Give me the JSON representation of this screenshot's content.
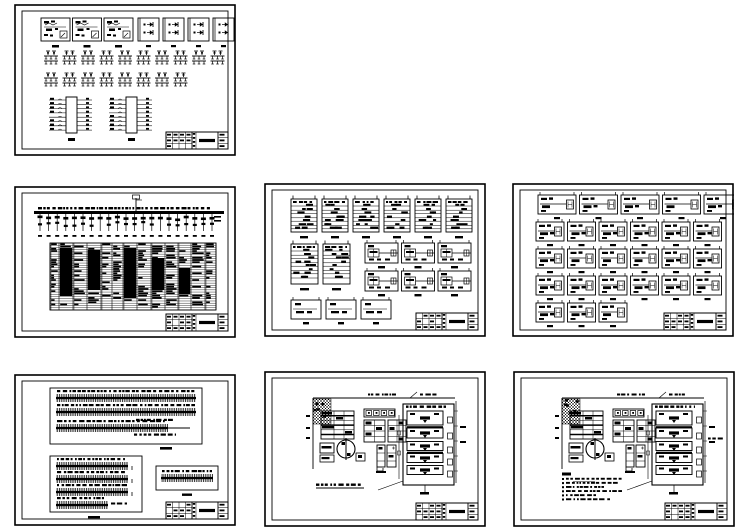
{
  "page": {
    "width": 749,
    "height": 530,
    "background": "#ffffff",
    "ink": "#000000",
    "kind": "cad-drawing-set-overview",
    "sheet_count": 7
  },
  "sheets": [
    {
      "id": "sheet-1",
      "name": "control-modules-schematic-sheet",
      "x": 14,
      "y": 4,
      "w": 222,
      "h": 152,
      "type": "relay_sheet",
      "seed": 11,
      "content": {
        "module_boxes_complex": 3,
        "module_boxes_simple": 4,
        "symbols_row1": 10,
        "symbols_row2": 8,
        "terminal_blocks": 2,
        "terminal_block_pins_per_side": 8,
        "has_title_block": true
      }
    },
    {
      "id": "sheet-2",
      "name": "distribution-system-schedule-sheet",
      "x": 14,
      "y": 186,
      "w": 222,
      "h": 152,
      "type": "bus_table_sheet",
      "seed": 22,
      "content": {
        "busbar": true,
        "feeder_drops": 21,
        "table_rows": 30,
        "table_columns": 13,
        "has_title_block": true
      }
    },
    {
      "id": "sheet-3",
      "name": "panel-circuit-blocks-sheet",
      "x": 264,
      "y": 183,
      "w": 222,
      "h": 154,
      "type": "ladder_blocks_sheet",
      "seed": 33,
      "content": {
        "row1_blocks": 6,
        "tall_blocks": 2,
        "grid_blocks": 6,
        "row3_blocks": 3,
        "has_title_block": true
      }
    },
    {
      "id": "sheet-4",
      "name": "branch-circuit-blocks-sheet",
      "x": 512,
      "y": 183,
      "w": 222,
      "h": 154,
      "type": "wide_blocks_sheet",
      "seed": 44,
      "content": {
        "rows": [
          5,
          6,
          6,
          6,
          3
        ],
        "has_title_block": true
      }
    },
    {
      "id": "sheet-5",
      "name": "terminal-strip-wiring-sheet",
      "x": 14,
      "y": 374,
      "w": 222,
      "h": 152,
      "type": "terminal_strips_sheet",
      "seed": 55,
      "content": {
        "group1_strips": 3,
        "group2_strips": 4,
        "group3_strips": 1,
        "has_title_block": true
      }
    },
    {
      "id": "sheet-6",
      "name": "equipment-layout-plan-sheet",
      "x": 264,
      "y": 371,
      "w": 222,
      "h": 156,
      "type": "plan_sheet",
      "seed": 66,
      "content": {
        "stacked_units": 5,
        "notes_lines": 1,
        "hatch_block": true,
        "pump_circle": true,
        "has_title_block": true
      }
    },
    {
      "id": "sheet-7",
      "name": "equipment-layout-plan-with-notes-sheet",
      "x": 513,
      "y": 371,
      "w": 222,
      "h": 156,
      "type": "plan_sheet",
      "seed": 77,
      "content": {
        "stacked_units": 5,
        "notes_lines": 6,
        "hatch_block": true,
        "pump_circle": true,
        "has_title_block": true
      }
    }
  ]
}
